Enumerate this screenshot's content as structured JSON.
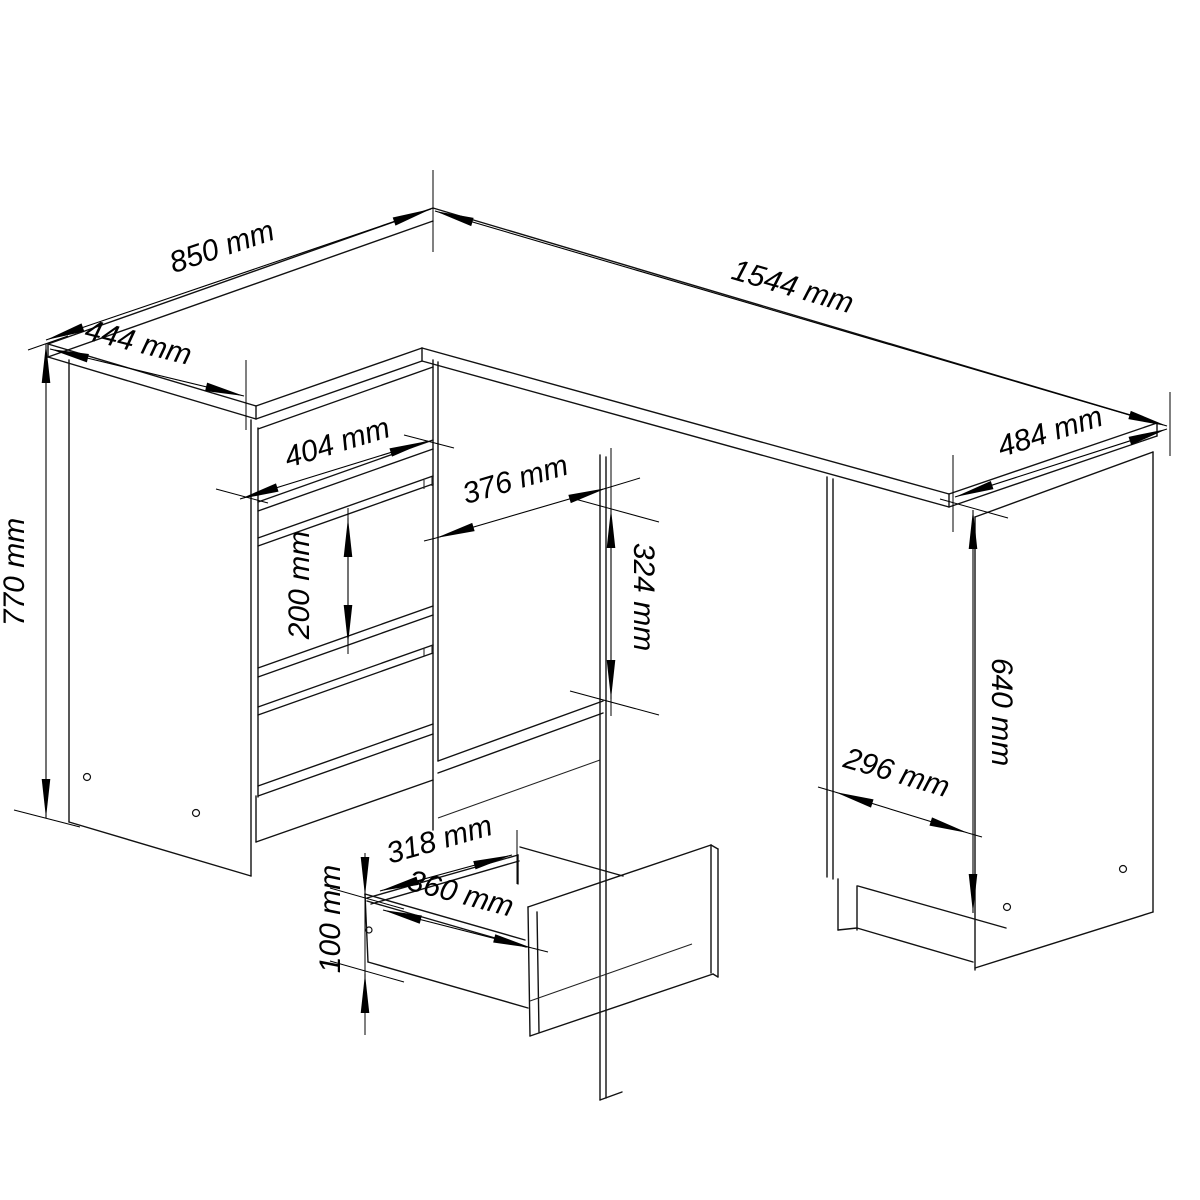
{
  "diagram": {
    "type": "technical-drawing",
    "subject": "corner desk with drawer cabinet, open niche, side cabinet and detached drawer box",
    "unit": "mm",
    "background_color": "#ffffff",
    "line_color": "#000000",
    "labels": {
      "depth_left": "850 mm",
      "width_left": "444 mm",
      "width_total": "1544 mm",
      "depth_right": "484 mm",
      "height_left": "770 mm",
      "drawer_front_width": "404 mm",
      "niche_width": "376 mm",
      "niche_height": "324 mm",
      "drawer_front_height": "200 mm",
      "right_side_height": "640 mm",
      "right_cabinet_width": "296 mm",
      "drawer_inner_width": "318 mm",
      "drawer_depth": "360 mm",
      "drawer_side_height": "100 mm"
    }
  }
}
